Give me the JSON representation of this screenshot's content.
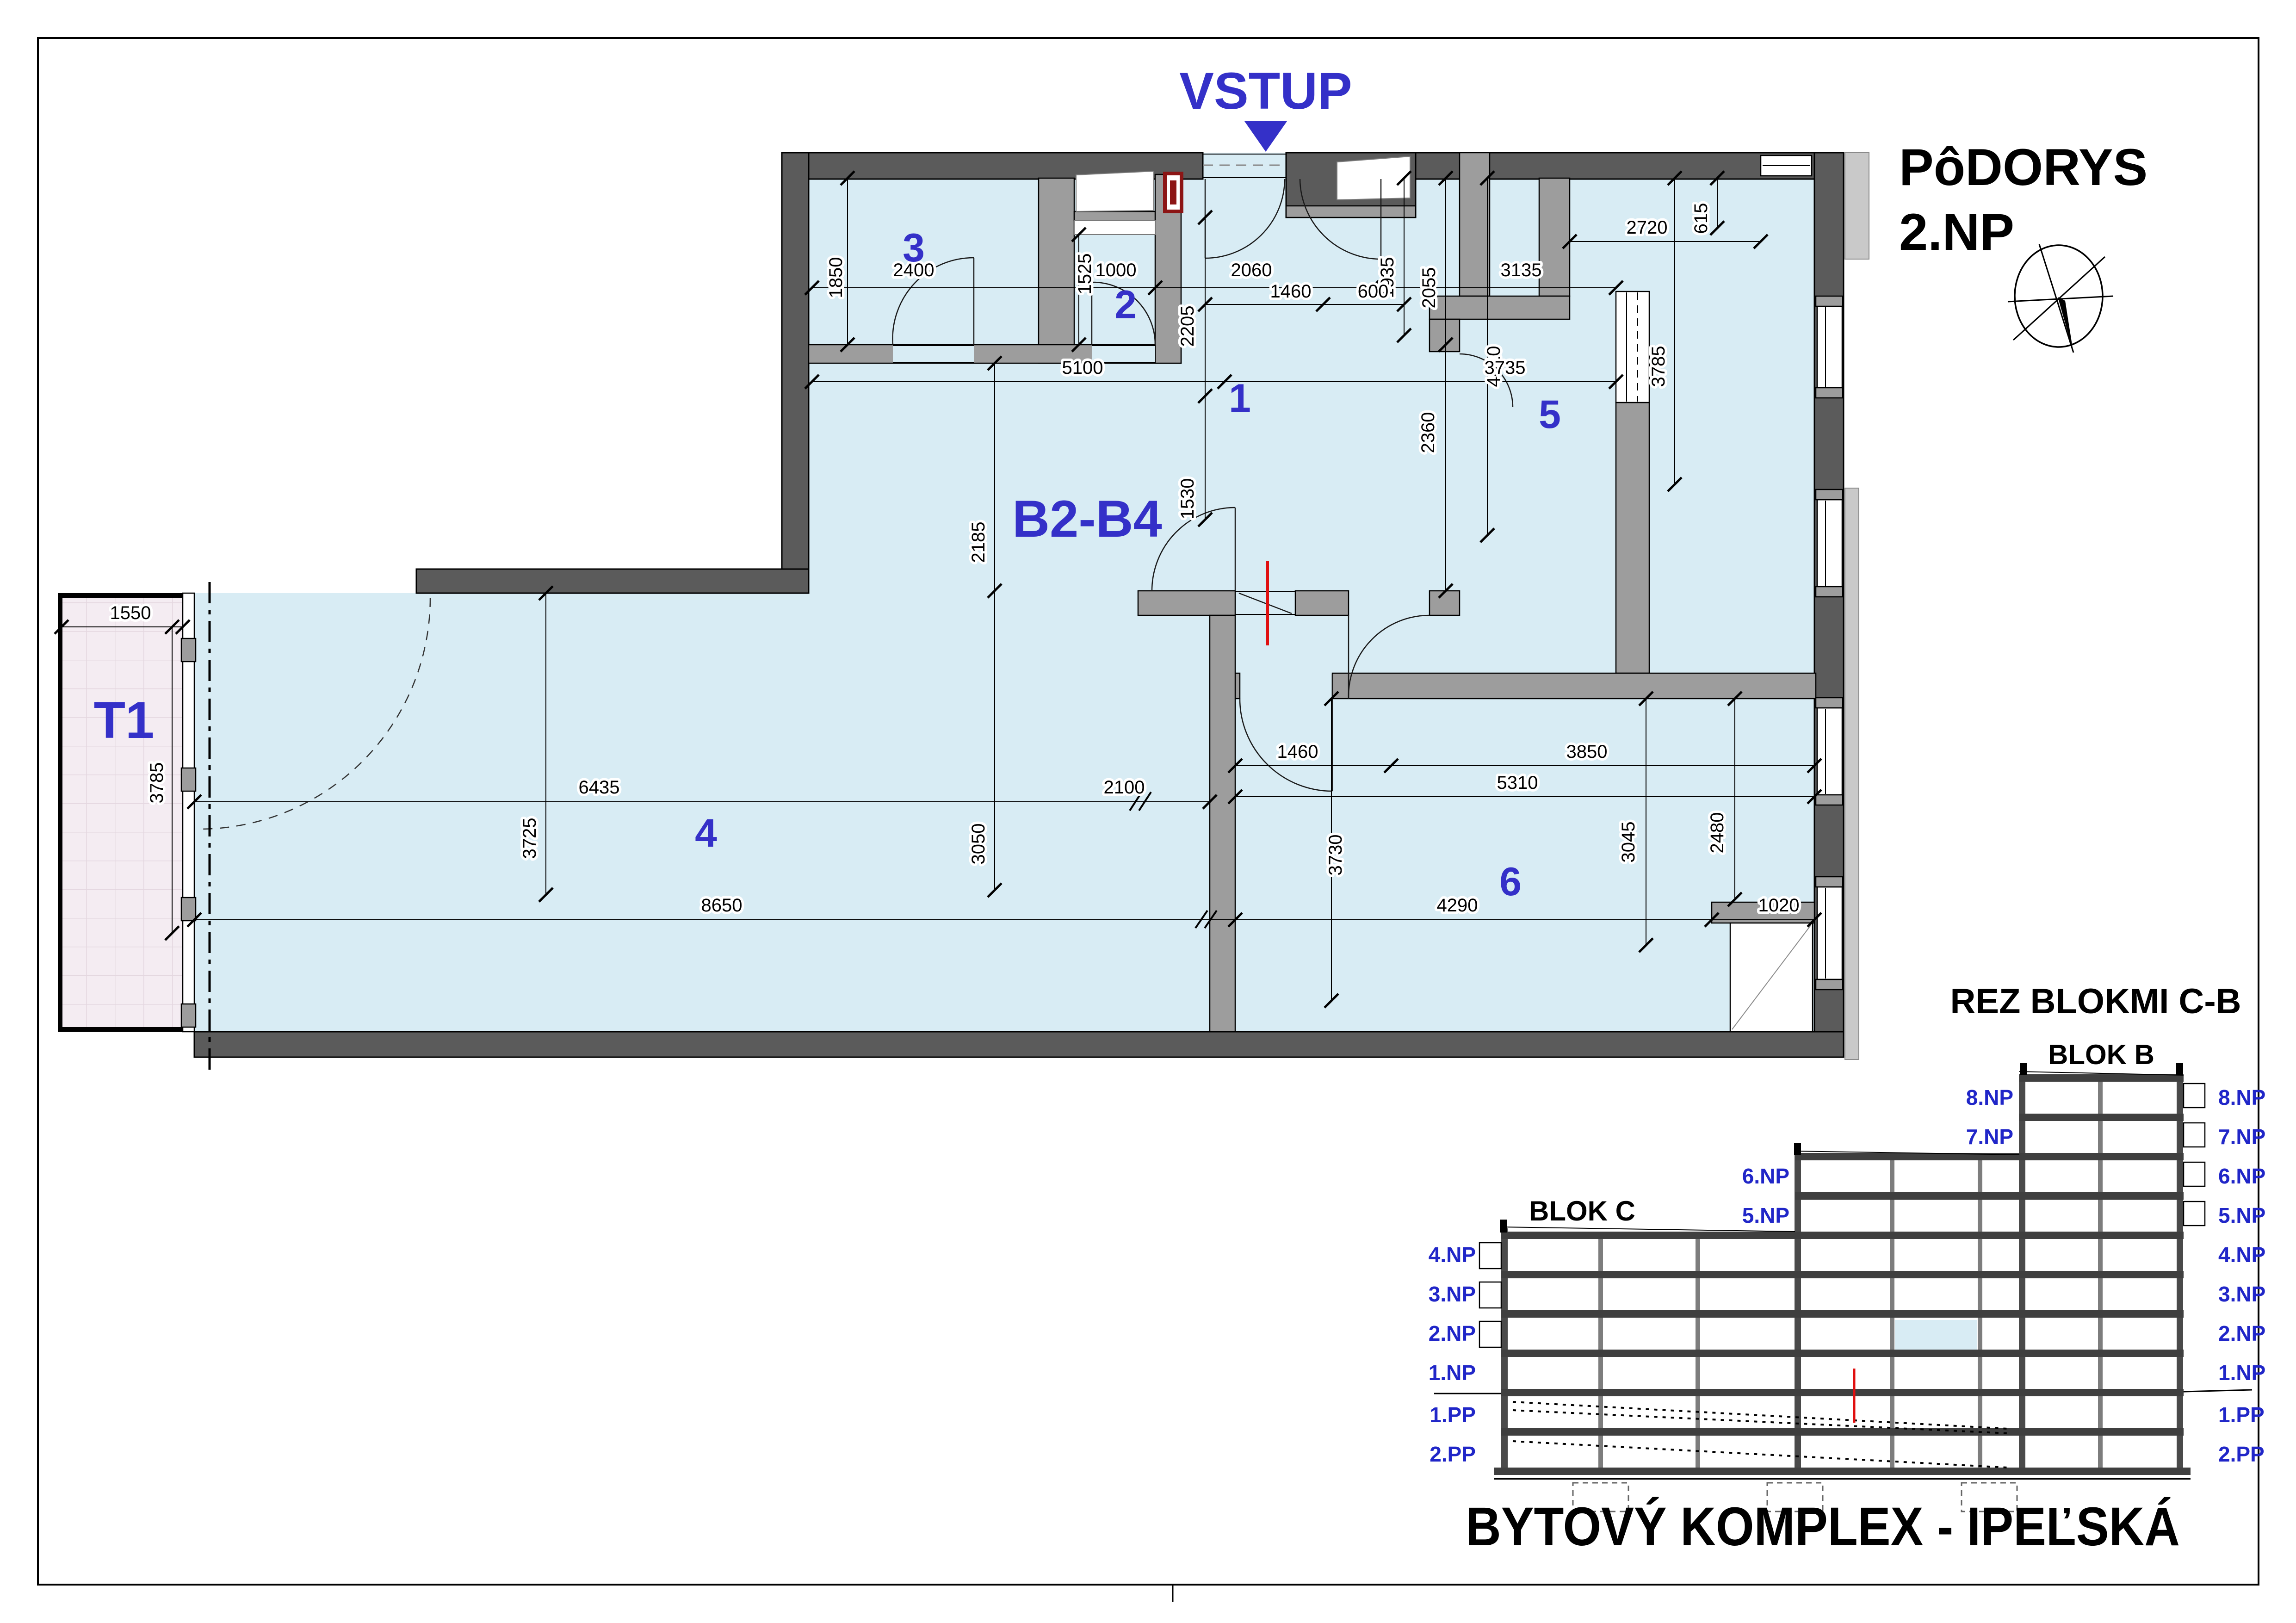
{
  "page": {
    "plan_title_line1": "PôDORYS",
    "plan_title_line2": "2.NP",
    "project_title": "BYTOVÝ KOMPLEX - IPEĽSKÁ"
  },
  "plan": {
    "entrance_label": "VSTUP",
    "apartment_label": "B2-B4",
    "terrace_label": "T1",
    "rooms": [
      {
        "number": "1"
      },
      {
        "number": "2"
      },
      {
        "number": "3"
      },
      {
        "number": "4"
      },
      {
        "number": "5"
      },
      {
        "number": "6"
      }
    ],
    "dims": [
      {
        "value": "1850"
      },
      {
        "value": "2400"
      },
      {
        "value": "1525"
      },
      {
        "value": "1000"
      },
      {
        "value": "2060"
      },
      {
        "value": "1935"
      },
      {
        "value": "2055"
      },
      {
        "value": "2720"
      },
      {
        "value": "615"
      },
      {
        "value": "3135"
      },
      {
        "value": "1460"
      },
      {
        "value": "600"
      },
      {
        "value": "2205"
      },
      {
        "value": "4410"
      },
      {
        "value": "3785"
      },
      {
        "value": "5100"
      },
      {
        "value": "1530"
      },
      {
        "value": "3735"
      },
      {
        "value": "2185"
      },
      {
        "value": "2360"
      },
      {
        "value": "1550"
      },
      {
        "value": "3785"
      },
      {
        "value": "6435"
      },
      {
        "value": "2100"
      },
      {
        "value": "1460"
      },
      {
        "value": "3850"
      },
      {
        "value": "5310"
      },
      {
        "value": "3725"
      },
      {
        "value": "3050"
      },
      {
        "value": "3730"
      },
      {
        "value": "3045"
      },
      {
        "value": "2480"
      },
      {
        "value": "8650"
      },
      {
        "value": "4290"
      },
      {
        "value": "1020"
      }
    ]
  },
  "section": {
    "title": "REZ BLOKMI C-B",
    "blok_b_label": "BLOK B",
    "blok_c_label": "BLOK C",
    "blok_b_left_levels": [
      "8.NP",
      "7.NP"
    ],
    "mid_levels": [
      "6.NP",
      "5.NP"
    ],
    "left_levels": [
      "4.NP",
      "3.NP",
      "2.NP",
      "1.NP",
      "1.PP",
      "2.PP"
    ],
    "right_levels": [
      "8.NP",
      "7.NP",
      "6.NP",
      "5.NP",
      "4.NP",
      "3.NP",
      "2.NP",
      "1.NP",
      "1.PP",
      "2.PP"
    ]
  },
  "colors": {
    "room_fill": "#d8ecf4",
    "terrace_fill": "#f4ecf2",
    "wall_dark": "#5b5b5b",
    "wall_gray": "#9d9d9d",
    "accent_blue": "#3430c8",
    "section_label_blue": "#2026c8",
    "red_mark": "#e01010",
    "dark_red": "#8c1515"
  }
}
